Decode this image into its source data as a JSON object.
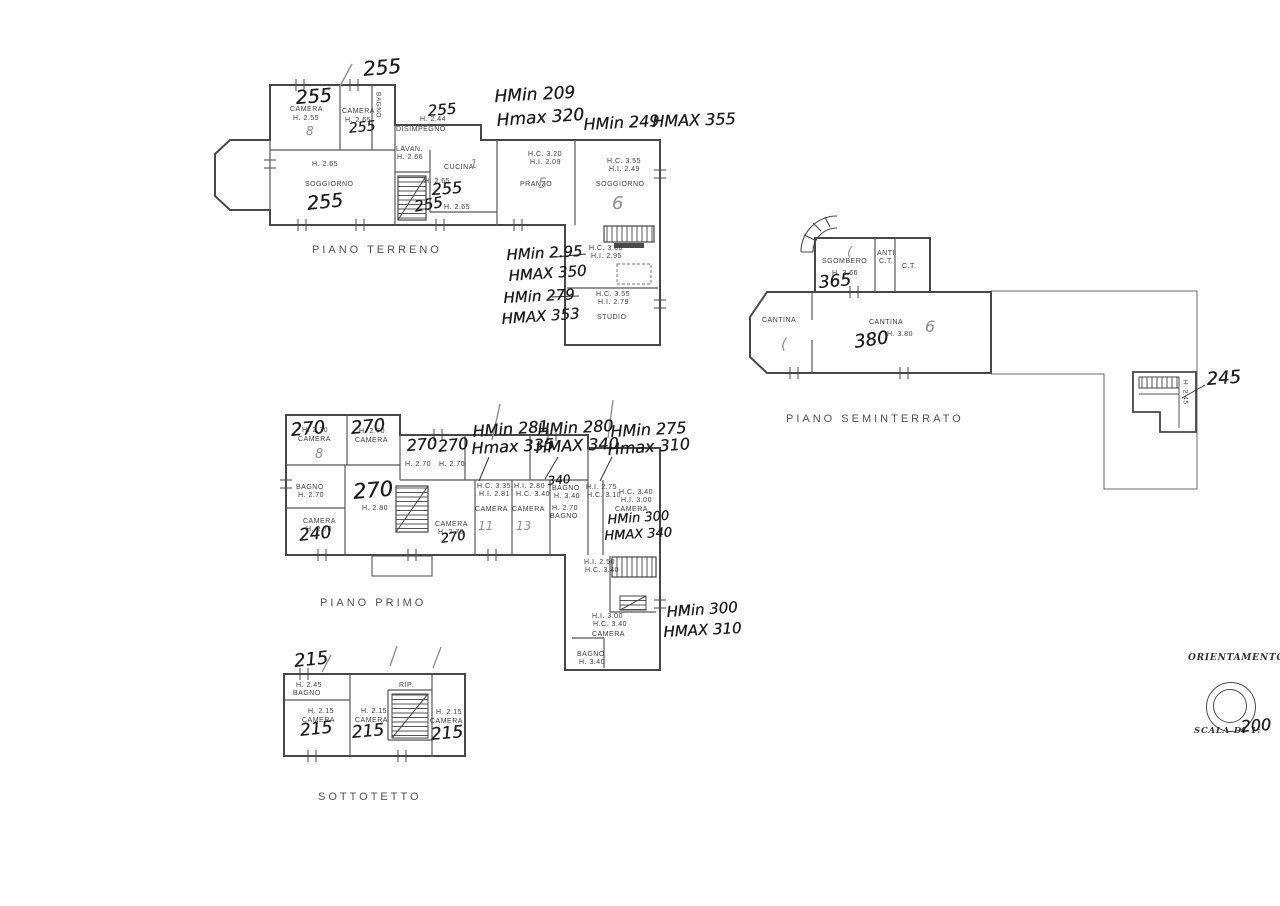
{
  "page": {
    "background": "#ffffff",
    "ink": "#474747"
  },
  "plans": [
    {
      "id": "piano-terreno",
      "title": {
        "t": "PIANO TERRENO",
        "x": 312,
        "y": 244
      },
      "printed": [
        {
          "t": "CAMERA",
          "x": 290,
          "y": 106
        },
        {
          "t": "H. 2.55",
          "x": 293,
          "y": 115
        },
        {
          "t": "CAMERA",
          "x": 342,
          "y": 108
        },
        {
          "t": "H. 2.65",
          "x": 345,
          "y": 117
        },
        {
          "t": "BAGNO",
          "x": 374,
          "y": 92,
          "c": "tv"
        },
        {
          "t": "H. 2.44",
          "x": 420,
          "y": 116
        },
        {
          "t": "DISIMPEGNO",
          "x": 396,
          "y": 126
        },
        {
          "t": "LAVAN.",
          "x": 396,
          "y": 146
        },
        {
          "t": "H. 2.66",
          "x": 397,
          "y": 154
        },
        {
          "t": "CUCINA",
          "x": 444,
          "y": 164
        },
        {
          "t": "H. 2.65",
          "x": 424,
          "y": 178
        },
        {
          "t": "H. 2.65",
          "x": 444,
          "y": 204
        },
        {
          "t": "H. 2.65",
          "x": 312,
          "y": 161
        },
        {
          "t": "SOGGIORNO",
          "x": 305,
          "y": 181
        },
        {
          "t": "H.C. 3.20",
          "x": 528,
          "y": 151
        },
        {
          "t": "H.I. 2.09",
          "x": 530,
          "y": 159
        },
        {
          "t": "PRANZO",
          "x": 520,
          "y": 181
        },
        {
          "t": "H.C. 3.55",
          "x": 607,
          "y": 158
        },
        {
          "t": "H.I. 2.49",
          "x": 609,
          "y": 166
        },
        {
          "t": "SOGGIORNO",
          "x": 596,
          "y": 181
        },
        {
          "t": "H.C. 3.60",
          "x": 589,
          "y": 245
        },
        {
          "t": "H.I. 2.95",
          "x": 591,
          "y": 253
        },
        {
          "t": "H.C. 3.55",
          "x": 596,
          "y": 291
        },
        {
          "t": "H.I. 2.79",
          "x": 598,
          "y": 299
        },
        {
          "t": "STUDIO",
          "x": 597,
          "y": 314
        }
      ],
      "handwritten": [
        {
          "t": "255",
          "x": 362,
          "y": 58,
          "s": 20,
          "r": -5
        },
        {
          "t": "255",
          "x": 295,
          "y": 88,
          "s": 19,
          "r": -4
        },
        {
          "t": "255",
          "x": 348,
          "y": 121,
          "s": 14,
          "r": -6
        },
        {
          "t": "255",
          "x": 427,
          "y": 103,
          "s": 15,
          "r": -5
        },
        {
          "t": "255",
          "x": 431,
          "y": 181,
          "s": 16,
          "r": -4
        },
        {
          "t": "255",
          "x": 413,
          "y": 199,
          "s": 15,
          "r": -10
        },
        {
          "t": "255",
          "x": 306,
          "y": 194,
          "s": 19,
          "r": -6
        },
        {
          "t": "HMin 209",
          "x": 494,
          "y": 88,
          "s": 17,
          "r": -3
        },
        {
          "t": "Hmax 320",
          "x": 496,
          "y": 112,
          "s": 17,
          "r": -4
        },
        {
          "t": "HMin 249",
          "x": 583,
          "y": 116,
          "s": 16,
          "r": -3
        },
        {
          "t": "HMAX 355",
          "x": 652,
          "y": 113,
          "s": 16,
          "r": -2
        },
        {
          "t": "HMin 2.95",
          "x": 506,
          "y": 247,
          "s": 15,
          "r": -3
        },
        {
          "t": "HMAX 350",
          "x": 508,
          "y": 268,
          "s": 15,
          "r": -4
        },
        {
          "t": "HMin 279",
          "x": 503,
          "y": 290,
          "s": 15,
          "r": -3
        },
        {
          "t": "HMAX 353",
          "x": 501,
          "y": 311,
          "s": 15,
          "r": -4
        }
      ],
      "pencil": [
        {
          "t": "8",
          "x": 306,
          "y": 125,
          "s": 12
        },
        {
          "t": "5",
          "x": 538,
          "y": 176,
          "s": 14
        },
        {
          "t": "6",
          "x": 612,
          "y": 194,
          "s": 18
        },
        {
          "t": "1",
          "x": 470,
          "y": 158,
          "s": 12
        }
      ]
    },
    {
      "id": "piano-primo",
      "title": {
        "t": "PIANO PRIMO",
        "x": 320,
        "y": 597
      },
      "printed": [
        {
          "t": "H. 2.70",
          "x": 302,
          "y": 427
        },
        {
          "t": "CAMERA",
          "x": 298,
          "y": 436
        },
        {
          "t": "H. 2.70",
          "x": 359,
          "y": 428
        },
        {
          "t": "CAMERA",
          "x": 355,
          "y": 437
        },
        {
          "t": "H. 2.70",
          "x": 405,
          "y": 461
        },
        {
          "t": "H. 2.70",
          "x": 439,
          "y": 461
        },
        {
          "t": "BAGNO",
          "x": 296,
          "y": 484
        },
        {
          "t": "H. 2.70",
          "x": 298,
          "y": 492
        },
        {
          "t": "CAMERA",
          "x": 303,
          "y": 518
        },
        {
          "t": "H. 2.70",
          "x": 306,
          "y": 526
        },
        {
          "t": "H. 2.80",
          "x": 362,
          "y": 505
        },
        {
          "t": "CAMERA",
          "x": 435,
          "y": 521
        },
        {
          "t": "H. 2.70",
          "x": 438,
          "y": 529
        },
        {
          "t": "H.C. 3.35",
          "x": 477,
          "y": 483
        },
        {
          "t": "H.I. 2.81",
          "x": 479,
          "y": 491
        },
        {
          "t": "CAMERA",
          "x": 475,
          "y": 506
        },
        {
          "t": "H.I. 2.80",
          "x": 514,
          "y": 483
        },
        {
          "t": "H.C. 3.40",
          "x": 516,
          "y": 491
        },
        {
          "t": "CAMERA",
          "x": 512,
          "y": 506
        },
        {
          "t": "BAGNO",
          "x": 552,
          "y": 485
        },
        {
          "t": "H. 3.40",
          "x": 554,
          "y": 493
        },
        {
          "t": "H. 2.70",
          "x": 552,
          "y": 505
        },
        {
          "t": "BAGNO",
          "x": 550,
          "y": 513
        },
        {
          "t": "H.I. 2.75",
          "x": 586,
          "y": 484
        },
        {
          "t": "H.C. 3.10",
          "x": 587,
          "y": 492
        },
        {
          "t": "H.C. 3.40",
          "x": 619,
          "y": 489
        },
        {
          "t": "H.I. 3.00",
          "x": 621,
          "y": 497
        },
        {
          "t": "CAMERA",
          "x": 615,
          "y": 506
        },
        {
          "t": "H.I. 2.50",
          "x": 584,
          "y": 559
        },
        {
          "t": "H.C. 3.40",
          "x": 585,
          "y": 567
        },
        {
          "t": "H.I. 3.00",
          "x": 592,
          "y": 613
        },
        {
          "t": "H.C. 3.40",
          "x": 593,
          "y": 621
        },
        {
          "t": "CAMERA",
          "x": 592,
          "y": 631
        },
        {
          "t": "BAGNO",
          "x": 577,
          "y": 651
        },
        {
          "t": "H. 3.40",
          "x": 579,
          "y": 659
        }
      ],
      "handwritten": [
        {
          "t": "270",
          "x": 290,
          "y": 421,
          "s": 18,
          "r": -5
        },
        {
          "t": "270",
          "x": 350,
          "y": 419,
          "s": 18,
          "r": -5
        },
        {
          "t": "270",
          "x": 406,
          "y": 437,
          "s": 16,
          "r": -4
        },
        {
          "t": "270",
          "x": 437,
          "y": 438,
          "s": 16,
          "r": -6
        },
        {
          "t": "HMin 281",
          "x": 472,
          "y": 423,
          "s": 16,
          "r": -4
        },
        {
          "t": "Hmax 335",
          "x": 471,
          "y": 440,
          "s": 16,
          "r": -3
        },
        {
          "t": "HMin 280",
          "x": 537,
          "y": 421,
          "s": 16,
          "r": -3
        },
        {
          "t": "HMAX 340",
          "x": 535,
          "y": 439,
          "s": 16,
          "r": -3
        },
        {
          "t": "HMin 275",
          "x": 610,
          "y": 423,
          "s": 16,
          "r": -3
        },
        {
          "t": "Hmax 310",
          "x": 607,
          "y": 441,
          "s": 16,
          "r": -4
        },
        {
          "t": "270",
          "x": 352,
          "y": 480,
          "s": 21,
          "r": -5
        },
        {
          "t": "240",
          "x": 298,
          "y": 527,
          "s": 17,
          "r": -6
        },
        {
          "t": "270",
          "x": 440,
          "y": 533,
          "s": 13,
          "r": -8
        },
        {
          "t": "340",
          "x": 547,
          "y": 475,
          "s": 12,
          "r": -5
        },
        {
          "t": "HMin 300",
          "x": 607,
          "y": 514,
          "s": 13,
          "r": -4
        },
        {
          "t": "HMAX 340",
          "x": 604,
          "y": 530,
          "s": 13,
          "r": -3
        },
        {
          "t": "HMin 300",
          "x": 666,
          "y": 604,
          "s": 15,
          "r": -4
        },
        {
          "t": "HMAX 310",
          "x": 663,
          "y": 624,
          "s": 15,
          "r": -3
        }
      ],
      "pencil": [
        {
          "t": "8",
          "x": 315,
          "y": 448,
          "s": 13
        },
        {
          "t": "11",
          "x": 478,
          "y": 520,
          "s": 12
        },
        {
          "t": "13",
          "x": 516,
          "y": 520,
          "s": 12
        }
      ]
    },
    {
      "id": "sottotetto",
      "title": {
        "t": "SOTTOTETTO",
        "x": 318,
        "y": 791
      },
      "printed": [
        {
          "t": "H. 2.45",
          "x": 296,
          "y": 682
        },
        {
          "t": "BAGNO",
          "x": 293,
          "y": 690
        },
        {
          "t": "H. 2.15",
          "x": 308,
          "y": 708
        },
        {
          "t": "CAMERA",
          "x": 302,
          "y": 717
        },
        {
          "t": "H. 2.15",
          "x": 361,
          "y": 708
        },
        {
          "t": "CAMERA",
          "x": 355,
          "y": 717
        },
        {
          "t": "RIP.",
          "x": 399,
          "y": 682
        },
        {
          "t": "H. 2.15",
          "x": 436,
          "y": 709
        },
        {
          "t": "CAMERA",
          "x": 430,
          "y": 718
        }
      ],
      "handwritten": [
        {
          "t": "215",
          "x": 293,
          "y": 652,
          "s": 18,
          "r": -6
        },
        {
          "t": "215",
          "x": 299,
          "y": 722,
          "s": 17,
          "r": -6
        },
        {
          "t": "215",
          "x": 351,
          "y": 724,
          "s": 17,
          "r": -5
        },
        {
          "t": "215",
          "x": 430,
          "y": 726,
          "s": 17,
          "r": -5
        }
      ],
      "pencil": []
    },
    {
      "id": "piano-seminterrato",
      "title": {
        "t": "PIANO SEMINTERRATO",
        "x": 786,
        "y": 413
      },
      "printed": [
        {
          "t": "SGOMBERO",
          "x": 822,
          "y": 258
        },
        {
          "t": "H. 3.66",
          "x": 832,
          "y": 270
        },
        {
          "t": "ANTI",
          "x": 877,
          "y": 250
        },
        {
          "t": "C.T.",
          "x": 879,
          "y": 258
        },
        {
          "t": "C.T.",
          "x": 902,
          "y": 263
        },
        {
          "t": "CANTINA",
          "x": 762,
          "y": 317
        },
        {
          "t": "CANTINA",
          "x": 869,
          "y": 319
        },
        {
          "t": "H. 3.80",
          "x": 887,
          "y": 331
        },
        {
          "t": "H. 2.45",
          "x": 1181,
          "y": 380,
          "c": "tv"
        }
      ],
      "handwritten": [
        {
          "t": "365",
          "x": 818,
          "y": 274,
          "s": 17,
          "r": -5
        },
        {
          "t": "380",
          "x": 853,
          "y": 333,
          "s": 18,
          "r": -8
        },
        {
          "t": "245",
          "x": 1206,
          "y": 370,
          "s": 18,
          "r": -4
        }
      ],
      "pencil": [
        {
          "t": "6",
          "x": 925,
          "y": 318,
          "s": 16
        },
        {
          "t": "(",
          "x": 781,
          "y": 336,
          "s": 15
        },
        {
          "t": "(",
          "x": 847,
          "y": 246,
          "s": 13
        }
      ]
    }
  ],
  "compass": {
    "orientation_label": "ORIENTAMENTO",
    "scale_label": "SCALA DI 1:",
    "scale_value": "200"
  }
}
